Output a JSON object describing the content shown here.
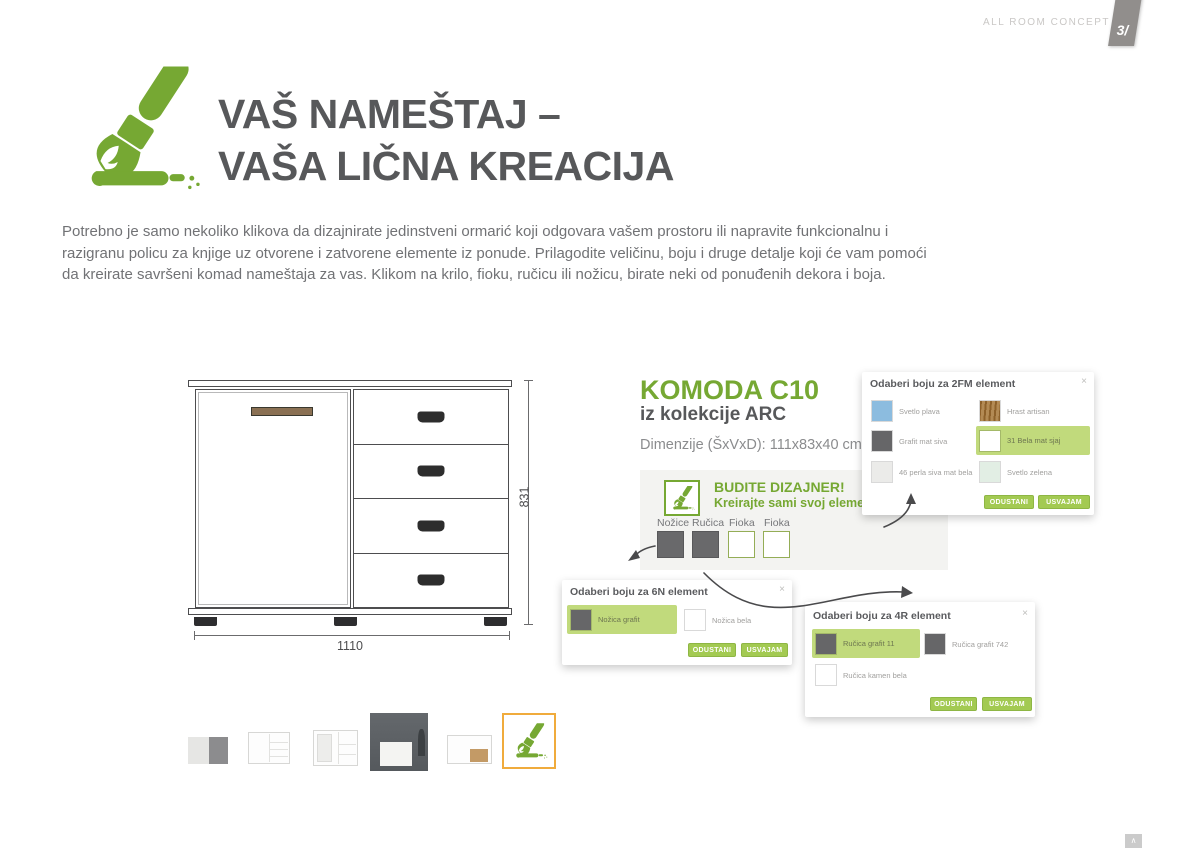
{
  "header": {
    "brand": "ALL ROOM CONCEPT",
    "page_number": "3/",
    "title_line1": "VAŠ NAMEŠTAJ –",
    "title_line2": "VAŠA LIČNA KREACIJA"
  },
  "intro": "Potrebno je samo nekoliko klikova da dizajnirate jedinstveni ormarić koji odgovara vašem prostoru ili napravite funkcionalnu i razigranu policu za knjige uz otvorene i zatvorene elemente iz ponude. Prilagodite veličinu, boju i druge detalje koji će vam pomoći da kreirate savršeni komad nameštaja za vas. Klikom na krilo, fioku, ručicu ili nožicu, birate neki od ponuđenih dekora i boja.",
  "drawing": {
    "width_label": "1110",
    "height_label": "831"
  },
  "product": {
    "name": "KOMODA C10",
    "collection": "iz kolekcije ARC",
    "dimensions": "Dimenzije (ŠxVxD): 111x83x40 cm"
  },
  "designer": {
    "heading": "BUDITE DIZAJNER!",
    "subheading": "Kreirajte sami svoj element",
    "parts": [
      {
        "label": "Nožice"
      },
      {
        "label": "Ručica"
      },
      {
        "label": "Fioka"
      },
      {
        "label": "Fioka"
      }
    ]
  },
  "dialogs": {
    "d2fm": {
      "title": "Odaberi boju za 2FM element",
      "close_icon": "×",
      "swatches": [
        {
          "label": "Svetlo plava",
          "color": "#8cbcdf",
          "selected": false
        },
        {
          "label": "Hrast artisan",
          "color": "#a97a3c",
          "selected": false
        },
        {
          "label": "Grafit mat siva",
          "color": "#666668",
          "selected": false
        },
        {
          "label": "31 Bela mat sjaj",
          "color": "#ffffff",
          "selected": true
        },
        {
          "label": "46 perla siva mat bela",
          "color": "#ebebe9",
          "selected": false
        },
        {
          "label": "Svetlo zelena",
          "color": "#e2eee4",
          "selected": false
        }
      ],
      "cancel_label": "ODUSTANI",
      "confirm_label": "USVAJAM"
    },
    "d6n": {
      "title": "Odaberi boju za 6N element",
      "close_icon": "×",
      "swatches": [
        {
          "label": "Nožica grafit",
          "color": "#666668",
          "selected": true
        },
        {
          "label": "Nožica bela",
          "color": "#ffffff",
          "selected": false
        }
      ],
      "cancel_label": "ODUSTANI",
      "confirm_label": "USVAJAM"
    },
    "d4r": {
      "title": "Odaberi boju za 4R element",
      "close_icon": "×",
      "swatches": [
        {
          "label": "Ručica grafit 11",
          "color": "#666668",
          "selected": true
        },
        {
          "label": "Ručica grafit 742",
          "color": "#666668",
          "selected": false
        },
        {
          "label": "Ručica kamen bela",
          "color": "#ffffff",
          "selected": false
        }
      ],
      "cancel_label": "ODUSTANI",
      "confirm_label": "USVAJAM"
    }
  },
  "colors": {
    "accent_green": "#76a833",
    "button_green": "#a3ca52",
    "highlight_green": "#c1da7c",
    "selected_thumb_orange": "#f0ab3c"
  },
  "icons": {
    "paintbrush": "paintbrush",
    "scroll_top": "∧"
  }
}
